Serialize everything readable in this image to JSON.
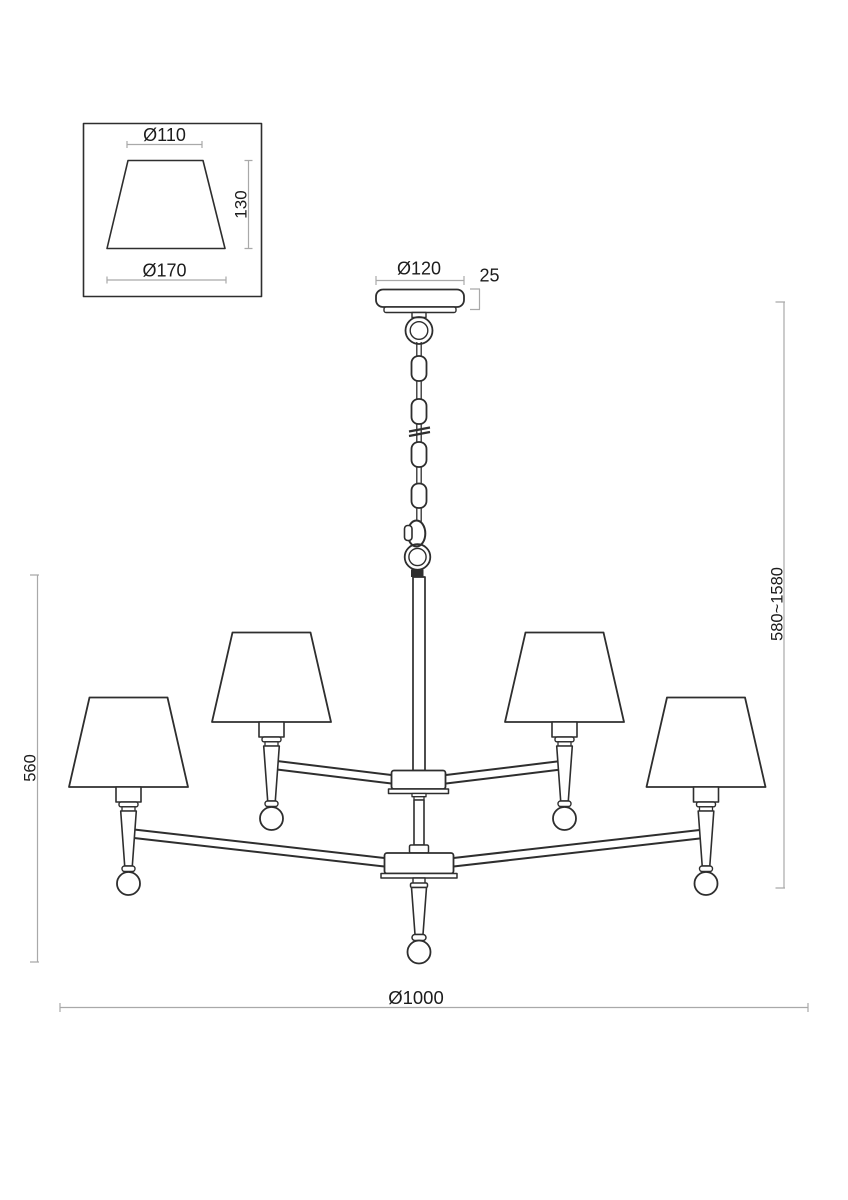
{
  "detail_view": {
    "shade_top_diameter": "Ø110",
    "shade_height": "130",
    "shade_bottom_diameter": "Ø170"
  },
  "main_view": {
    "canopy_diameter": "Ø120",
    "canopy_height": "25",
    "suspension_height_range": "580~1580",
    "fixture_height": "560",
    "overall_diameter": "Ø1000"
  },
  "colors": {
    "line": "#2e2e2e",
    "dimension": "#a9a9a9",
    "text": "#1c1c1c",
    "background": "#ffffff"
  }
}
